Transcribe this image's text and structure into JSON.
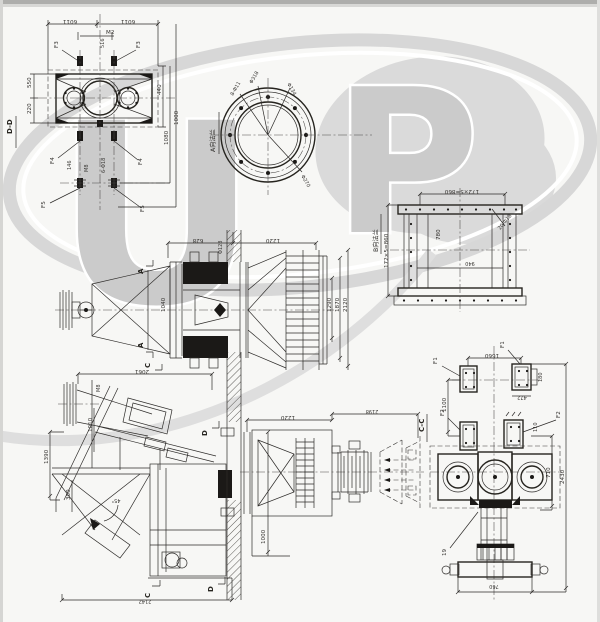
{
  "colors": {
    "paper": "#f7f7f5",
    "ink": "#2e2c2a",
    "watermark": "#cbcbcb",
    "blob": "#dadada"
  },
  "watermark": {
    "letter_u": "U",
    "letter_p": "P"
  },
  "view_dd": {
    "section_label": "D-D",
    "dim_top_left": "6011",
    "dim_top_right": "6011",
    "label_m2": "M2",
    "dim_516": "516",
    "f3_left": "F3",
    "f3_right": "F3",
    "dim_550": "550",
    "dim_220": "220",
    "dim_440": "440",
    "dim_1080": "1080",
    "dim_1000": "1000",
    "f4_left": "F4",
    "f4_right": "F4",
    "f5_left": "F5",
    "f5_right": "F5",
    "note_bolts": "6-Φ18",
    "note_m8": "M8",
    "note_146": "146"
  },
  "view_flange_a": {
    "title": "A向法兰",
    "note_holes": "8-Φ11",
    "dim_d134": "Φ134",
    "dim_d318": "Φ318",
    "dim_d270": "Φ270"
  },
  "view_frame_b": {
    "title": "B向法兰",
    "dim_top": "172×5=860",
    "dim_left": "172×5=860",
    "dim_780": "780",
    "dim_940": "940",
    "note_holes": "20-Φ18"
  },
  "view_side": {
    "dim_628": "628",
    "dim_1220": "1220",
    "note_d128": "Φ128",
    "marker_a_top": "A",
    "marker_a_bottom": "A",
    "dim_1040": "1040",
    "dim_1290": "1290",
    "dim_1870": "1870",
    "dim_2120": "2120"
  },
  "view_front": {
    "dim_2061": "2061",
    "note_m8": "M8",
    "dim_1390": "1390",
    "dim_1010": "1010",
    "dim_300": "300",
    "angle_45": "45°",
    "dim_bottom": "2142",
    "marker_c_top": "C",
    "marker_c_bottom": "C",
    "marker_d_top": "D",
    "marker_d_bottom": "D"
  },
  "view_outlet": {
    "dim_1220": "1220",
    "dim_2198": "2198",
    "dim_1000": "1000"
  },
  "view_cc": {
    "section_label": "C-C",
    "f1_left": "F1",
    "f1_top": "F1",
    "f2_left": "F2",
    "f2_right": "F2",
    "dim_1660": "1660",
    "dim_1100": "1100",
    "dim_710": "710",
    "dim_180": "180",
    "dim_472": "472",
    "dim_110": "110",
    "dim_2430": "2430",
    "dim_760": "760",
    "note_19": "19"
  }
}
